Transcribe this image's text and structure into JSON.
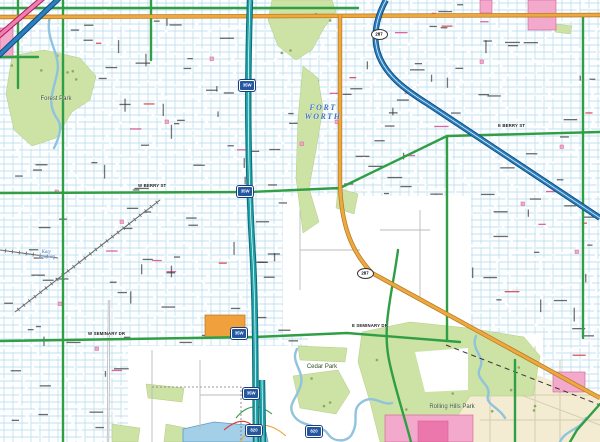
{
  "title": "Fort Worth street map detail",
  "city": {
    "line1": "FORT",
    "line2": "WORTH"
  },
  "labels": {
    "rolling_hills_park": "Rolling Hills Park",
    "cedar_park": "Cedar Park",
    "forest_park": "Forest Park",
    "katy_junction_1": "Katy",
    "katy_junction_2": "Junction",
    "w_berry": "W BERRY ST",
    "e_berry": "E BERRY ST",
    "w_seminary": "W SEMINARY DR",
    "e_seminary": "E SEMINARY DR"
  },
  "shields": {
    "interstate_35w": "35W",
    "interstate_820": "820",
    "us_287": "287"
  },
  "colors": {
    "grid": "#b3d7e8",
    "grid_strong": "#9cc6dc",
    "road_green": "#2f9e44",
    "orange_fill": "#eda83f",
    "orange_casing": "#b5761f",
    "teal_fill": "#1fa3ab",
    "teal_casing": "#0b6a72",
    "blue_fill": "#2b7fc0",
    "blue_casing": "#0d4d7a",
    "pink_band_fill": "#ef7fae",
    "pink_band_casing": "#b0175a",
    "park": "#cde2a5",
    "park_edge": "#b3cc85",
    "tree": "#8aab60",
    "water": "#8fc3de",
    "lake": "#a4cfe8",
    "lake_edge": "#5b9cc8",
    "beige": "#f3ecd2",
    "beige_street": "#d6cdb0",
    "pink_zone": "#f3a9cb",
    "pink_dark": "#ec77ad",
    "pink_edge": "#d45f96",
    "orange_block": "#f0a13e",
    "rail": "#6a6a6a",
    "micro_text": "#3a3a3a",
    "micro_pink": "#d63384",
    "micro_red": "#cc2222",
    "gray_road": "#9a9a9a",
    "sparse_street": "#bbbbbb",
    "boundary": "#777777"
  },
  "map": {
    "width": 600,
    "height": 442,
    "grid": {
      "v_step": 9,
      "h_step": 7
    },
    "white_zones": [
      [
        283,
        196,
        188,
        140
      ],
      [
        128,
        346,
        186,
        96
      ],
      [
        308,
        334,
        235,
        108
      ],
      [
        180,
        418,
        92,
        24
      ]
    ],
    "beige_poly": [
      [
        443,
        339
      ],
      [
        600,
        399
      ],
      [
        600,
        442
      ],
      [
        468,
        442
      ],
      [
        452,
        392
      ],
      [
        441,
        360
      ]
    ],
    "beige_streets": [
      "M490,352 L490,442",
      "M535,346 L535,442",
      "M560,360 L560,442",
      "M470,395 L600,395",
      "M480,420 L600,420",
      "M455,370 L600,425"
    ],
    "parks": [
      [
        [
          12,
          56
        ],
        [
          44,
          50
        ],
        [
          80,
          58
        ],
        [
          96,
          76
        ],
        [
          90,
          100
        ],
        [
          72,
          112
        ],
        [
          56,
          138
        ],
        [
          32,
          146
        ],
        [
          14,
          130
        ],
        [
          6,
          94
        ]
      ],
      [
        [
          272,
          0
        ],
        [
          332,
          0
        ],
        [
          336,
          12
        ],
        [
          324,
          28
        ],
        [
          312,
          50
        ],
        [
          296,
          60
        ],
        [
          278,
          46
        ],
        [
          268,
          20
        ]
      ],
      [
        [
          303,
          66
        ],
        [
          318,
          78
        ],
        [
          323,
          108
        ],
        [
          316,
          150
        ],
        [
          309,
          188
        ],
        [
          319,
          222
        ],
        [
          303,
          233
        ],
        [
          296,
          178
        ],
        [
          298,
          118
        ]
      ],
      [
        [
          338,
          188
        ],
        [
          358,
          194
        ],
        [
          354,
          214
        ],
        [
          336,
          208
        ]
      ],
      [
        [
          362,
          332
        ],
        [
          410,
          322
        ],
        [
          468,
          328
        ],
        [
          524,
          337
        ],
        [
          540,
          356
        ],
        [
          533,
          396
        ],
        [
          470,
          396
        ],
        [
          455,
          420
        ],
        [
          432,
          442
        ],
        [
          380,
          442
        ],
        [
          370,
          402
        ],
        [
          358,
          362
        ]
      ],
      [
        [
          298,
          346
        ],
        [
          347,
          348
        ],
        [
          345,
          362
        ],
        [
          300,
          360
        ]
      ],
      [
        [
          146,
          384
        ],
        [
          184,
          388
        ],
        [
          182,
          402
        ],
        [
          148,
          398
        ]
      ],
      [
        [
          112,
          424
        ],
        [
          140,
          428
        ],
        [
          138,
          442
        ],
        [
          112,
          442
        ]
      ],
      [
        [
          166,
          424
        ],
        [
          186,
          428
        ],
        [
          184,
          442
        ],
        [
          164,
          442
        ]
      ],
      [
        [
          293,
          376
        ],
        [
          338,
          370
        ],
        [
          350,
          392
        ],
        [
          336,
          414
        ],
        [
          300,
          408
        ]
      ],
      [
        [
          556,
          24
        ],
        [
          572,
          26
        ],
        [
          570,
          34
        ],
        [
          555,
          32
        ]
      ]
    ],
    "park_cutouts": [
      [
        [
          415,
          352
        ],
        [
          468,
          348
        ],
        [
          468,
          390
        ],
        [
          425,
          392
        ]
      ]
    ],
    "creeks": [
      "M50,16 C44,40 62,54 57,74 C53,92 46,104 58,120 C63,128 58,140 54,148",
      "M297,349 C290,362 304,370 301,384 C298,398 286,404 294,416 C302,428 322,424 328,434 C334,443 348,442 352,434 C360,420 350,410 362,402 C374,394 382,406 392,403",
      "M476,336 C470,350 486,356 480,368 C474,380 492,384 488,396 C485,404 500,408 505,418",
      "M560,442 C565,430 580,430 586,418"
    ],
    "lake": [
      [
        183,
        429
      ],
      [
        214,
        422
      ],
      [
        247,
        425
      ],
      [
        266,
        432
      ],
      [
        268,
        442
      ],
      [
        183,
        442
      ]
    ],
    "pink_zones": [
      [
        528,
        0,
        28,
        30
      ],
      [
        0,
        28,
        13,
        30
      ],
      [
        480,
        0,
        12,
        13
      ],
      [
        385,
        415,
        88,
        27
      ],
      [
        553,
        372,
        32,
        20
      ]
    ],
    "pink_dark_zones": [
      [
        418,
        421,
        30,
        21
      ]
    ],
    "orange_blocks": [
      [
        205,
        315,
        40,
        22
      ]
    ],
    "micro_buildings": [
      [
        95,
        347
      ],
      [
        210,
        57
      ],
      [
        300,
        142
      ],
      [
        432,
        13
      ],
      [
        521,
        202
      ],
      [
        58,
        302
      ],
      [
        165,
        120
      ],
      [
        480,
        60
      ],
      [
        560,
        145
      ],
      [
        120,
        220
      ],
      [
        405,
        90
      ],
      [
        55,
        190
      ],
      [
        575,
        250
      ],
      [
        335,
        120
      ]
    ],
    "railroads": [
      {
        "from": [
          160,
          200
        ],
        "to": [
          15,
          312
        ]
      },
      {
        "from": [
          58,
          258
        ],
        "to": [
          0,
          250
        ]
      }
    ],
    "rail_dash": "M446,345 L600,405",
    "boundary": "M152,387 L241,387 L241,442",
    "gray_roads": [
      "M109,300 L108,442"
    ],
    "sparse_streets": [
      "M152,350 L152,442",
      "M200,360 L200,430",
      "M200,395 L260,395",
      "M300,210 L300,290",
      "M300,250 L360,250",
      "M420,210 L420,300",
      "M380,230 L430,230"
    ],
    "green_roads": [
      "M0,8 L358,8",
      "M63,0 L63,442",
      "M151,0 L151,60",
      "M0,193 L250,192 L340,188",
      "M340,188 L447,136 L600,132",
      "M447,136 L447,341",
      "M0,341 L255,337 L347,333 L460,342",
      "M398,250 C392,295 382,325 389,360 C394,385 404,415 411,442",
      "M583,17 L583,338",
      "M515,360 L515,442",
      "M600,404 L577,430 L570,442",
      "M18,0 L18,88",
      "M0,57 L38,57"
    ],
    "orange_roads": [
      "M0,17 L600,15",
      "M340,15 L340,183 C341,226 352,252 372,273 L600,398"
    ],
    "teal_freeway": [
      "M250,0 C247,90 248,180 253,260 C256,320 255,370 256,442",
      "M262,380 L263,442"
    ],
    "blue_freeway": [
      "M386,0 C376,18 372,38 379,56 C387,76 404,89 428,104 L600,218"
    ],
    "pink_bands": [
      "M-6,40 L50,-8"
    ],
    "blue_bands": [
      "M-8,62 L72,-14"
    ],
    "ramps": [
      {
        "d": "M236,418 Q252,398 272,414",
        "c": "green"
      },
      {
        "d": "M240,442 Q258,412 286,436",
        "c": "orange"
      },
      {
        "d": "M224,430 Q250,408 262,442",
        "c": "red"
      }
    ],
    "tree_areas": [
      [
        365,
        330,
        170,
        100,
        8
      ],
      [
        10,
        52,
        85,
        92,
        6
      ],
      [
        270,
        2,
        62,
        54,
        4
      ],
      [
        295,
        372,
        50,
        38,
        3
      ]
    ]
  }
}
